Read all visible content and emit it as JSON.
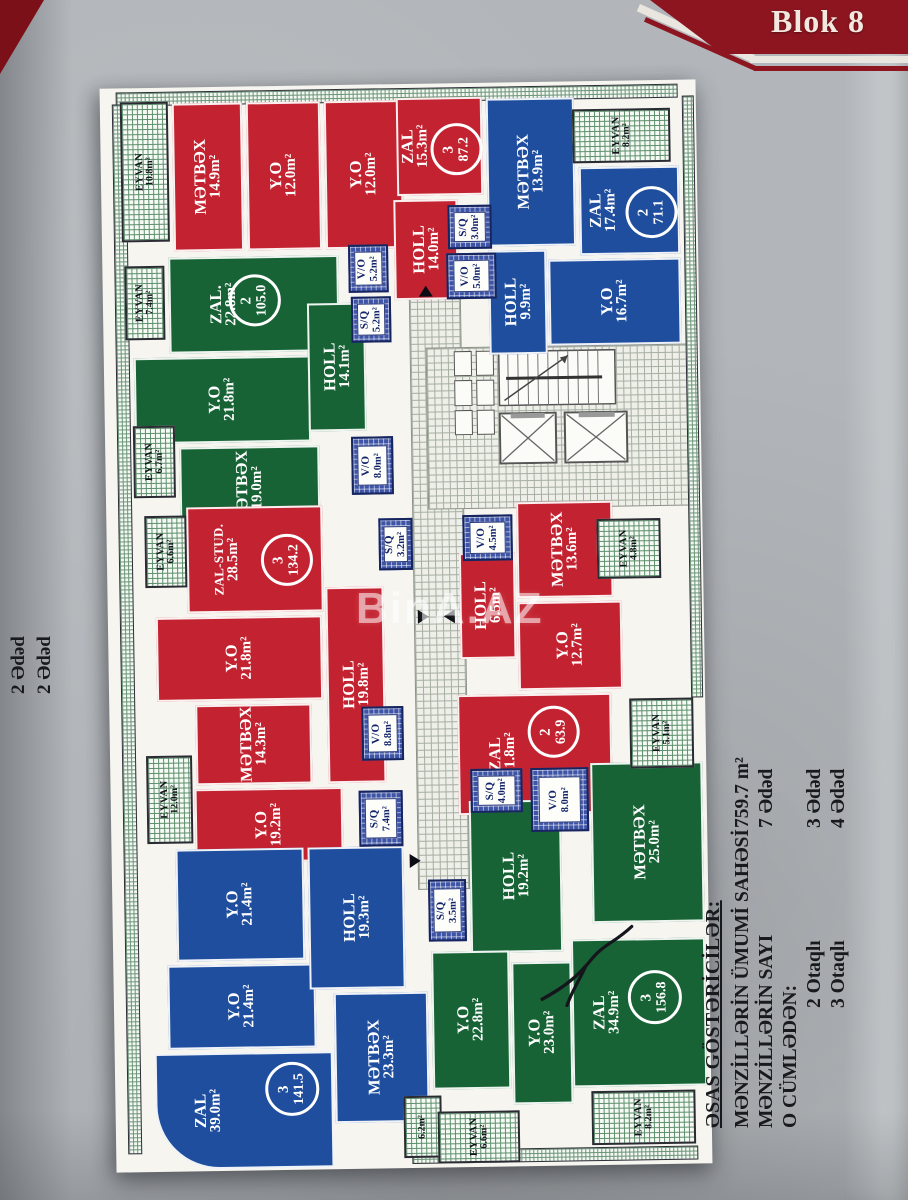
{
  "banner": {
    "title": "Blok 8"
  },
  "watermark_text": "BinA.AZ",
  "side_note": {
    "lines": [
      "2 Ədəd",
      "2 Ədəd"
    ]
  },
  "legend": {
    "title": "ƏSAS GÖSTƏRİCİLƏR:",
    "rows": [
      {
        "label": "MƏNZİLLƏRİN ÜMUMİ SAHƏSİ",
        "value": "759.7 m²",
        "indent": false
      },
      {
        "label": "MƏNZİLLƏRİN SAYI",
        "value": "7 Ədəd",
        "indent": false
      },
      {
        "label": "O CÜMLƏDƏN:",
        "value": "",
        "indent": false
      },
      {
        "label": "2 Otaqlı",
        "value": "3 Ədəd",
        "indent": true
      },
      {
        "label": "3 Otaqlı",
        "value": "4 Ədəd",
        "indent": true
      }
    ]
  },
  "colors": {
    "red": "#c32330",
    "blue": "#1e4e9d",
    "green": "#176335",
    "banner": "#8d1520",
    "corner": "#7c1019",
    "wet_hatch": "#3e54a6",
    "tile_floor": "#edefe8"
  },
  "plan": {
    "rooms": [
      {
        "type": "room",
        "color": "r",
        "name": "MƏTBƏX",
        "area": "14.9m²",
        "x": 72,
        "y": 16,
        "w": 70,
        "h": 148
      },
      {
        "type": "room",
        "color": "r",
        "name": "Y.O",
        "area": "12.0m²",
        "x": 146,
        "y": 16,
        "w": 74,
        "h": 148
      },
      {
        "type": "room",
        "color": "r",
        "name": "Y.O",
        "area": "12.0m²",
        "x": 224,
        "y": 16,
        "w": 78,
        "h": 148
      },
      {
        "type": "room",
        "color": "r",
        "name": "ZAL",
        "area": "15.3m²",
        "x": 296,
        "y": 14,
        "w": 86,
        "h": 98,
        "dx": -24
      },
      {
        "type": "room",
        "color": "r",
        "name": "HOLL",
        "area": "14.0m²",
        "x": 292,
        "y": 116,
        "w": 64,
        "h": 100
      },
      {
        "type": "balc",
        "name": "EYVAN",
        "area": "10.8m²",
        "x": 20,
        "y": 14,
        "w": 48,
        "h": 140
      },
      {
        "type": "wet",
        "name": "S/Q",
        "area": "3.0m²",
        "x": 346,
        "y": 122,
        "w": 44,
        "h": 44
      },
      {
        "type": "wet",
        "name": "V/O",
        "area": "5.0m²",
        "x": 344,
        "y": 170,
        "w": 50,
        "h": 46
      },
      {
        "type": "room",
        "color": "b",
        "name": "MƏTBƏX",
        "area": "13.9m²",
        "x": 386,
        "y": 16,
        "w": 88,
        "h": 148
      },
      {
        "type": "room",
        "color": "b",
        "name": "ZAL",
        "area": "17.4m²",
        "x": 478,
        "y": 86,
        "w": 100,
        "h": 88,
        "dx": -26
      },
      {
        "type": "room",
        "color": "b",
        "name": "Y.O",
        "area": "16.7m²",
        "x": 446,
        "y": 178,
        "w": 132,
        "h": 86
      },
      {
        "type": "room",
        "color": "b",
        "name": "HOLL",
        "area": "9.9m²",
        "x": 386,
        "y": 168,
        "w": 58,
        "h": 104
      },
      {
        "type": "balc",
        "name": "EYVAN",
        "area": "8.2m²",
        "x": 472,
        "y": 28,
        "w": 98,
        "h": 54
      },
      {
        "type": "room",
        "color": "g",
        "name": "ZAL.",
        "area": "22.8m²",
        "x": 66,
        "y": 170,
        "w": 170,
        "h": 96,
        "dx": -30
      },
      {
        "type": "room",
        "color": "g",
        "name": "Y.O",
        "area": "21.8m²",
        "x": 30,
        "y": 270,
        "w": 176,
        "h": 86
      },
      {
        "type": "room",
        "color": "g",
        "name": "MƏTBƏX",
        "area": "19.0m²",
        "x": 74,
        "y": 360,
        "w": 140,
        "h": 84
      },
      {
        "type": "room",
        "color": "g",
        "name": "HOLL",
        "area": "14.1m²",
        "x": 204,
        "y": 218,
        "w": 58,
        "h": 128
      },
      {
        "type": "wet",
        "name": "V/O",
        "area": "5.2m²",
        "x": 246,
        "y": 160,
        "w": 40,
        "h": 48
      },
      {
        "type": "wet",
        "name": "S/Q",
        "area": "5.2m²",
        "x": 248,
        "y": 212,
        "w": 40,
        "h": 46
      },
      {
        "type": "wet",
        "name": "V/O",
        "area": "8.0m²",
        "x": 246,
        "y": 352,
        "w": 42,
        "h": 58
      },
      {
        "type": "balc",
        "name": "EYVAN",
        "area": "7.4m²",
        "x": 22,
        "y": 178,
        "w": 40,
        "h": 74
      },
      {
        "type": "balc",
        "name": "EYVAN",
        "area": "6.7m²",
        "x": 28,
        "y": 338,
        "w": 42,
        "h": 72
      },
      {
        "type": "room",
        "color": "r",
        "name": "ZAL-STUD.",
        "area": "28.5m²",
        "x": 80,
        "y": 420,
        "w": 136,
        "h": 106,
        "dx": -28
      },
      {
        "type": "room",
        "color": "r",
        "name": "Y.O",
        "area": "21.8m²",
        "x": 48,
        "y": 530,
        "w": 166,
        "h": 84
      },
      {
        "type": "room",
        "color": "r",
        "name": "MƏTBƏX",
        "area": "14.3m²",
        "x": 86,
        "y": 618,
        "w": 116,
        "h": 80
      },
      {
        "type": "room",
        "color": "r",
        "name": "Y.O",
        "area": "19.2m²",
        "x": 84,
        "y": 702,
        "w": 148,
        "h": 74
      },
      {
        "type": "room",
        "color": "r",
        "name": "HOLL",
        "area": "19.8m²",
        "x": 218,
        "y": 502,
        "w": 58,
        "h": 196
      },
      {
        "type": "wet",
        "name": "S/Q",
        "area": "3.2m²",
        "x": 272,
        "y": 434,
        "w": 34,
        "h": 52
      },
      {
        "type": "wet",
        "name": "V/O",
        "area": "8.8m²",
        "x": 252,
        "y": 622,
        "w": 42,
        "h": 54
      },
      {
        "type": "wet",
        "name": "S/Q",
        "area": "7.4m²",
        "x": 248,
        "y": 706,
        "w": 44,
        "h": 56
      },
      {
        "type": "balc",
        "name": "EYVAN",
        "area": "6.6m²",
        "x": 38,
        "y": 428,
        "w": 42,
        "h": 72
      },
      {
        "type": "balc",
        "name": "EYVAN",
        "area": "12.0m²",
        "x": 36,
        "y": 668,
        "w": 46,
        "h": 88
      },
      {
        "type": "room",
        "color": "r",
        "name": "MƏTBƏX",
        "area": "13.6m²",
        "x": 410,
        "y": 420,
        "w": 96,
        "h": 96
      },
      {
        "type": "room",
        "color": "r",
        "name": "HOLL",
        "area": "6.5m²",
        "x": 352,
        "y": 470,
        "w": 56,
        "h": 106
      },
      {
        "type": "room",
        "color": "r",
        "name": "Y.O",
        "area": "12.7m²",
        "x": 410,
        "y": 520,
        "w": 104,
        "h": 88
      },
      {
        "type": "room",
        "color": "r",
        "name": "ZAL",
        "area": "21.8m²",
        "x": 348,
        "y": 612,
        "w": 154,
        "h": 120,
        "dx": -32
      },
      {
        "type": "wet",
        "name": "V/O",
        "area": "4.5m²",
        "x": 356,
        "y": 432,
        "w": 50,
        "h": 46
      },
      {
        "type": "balc",
        "name": "EYVAN",
        "area": "4.8m²",
        "x": 490,
        "y": 438,
        "w": 64,
        "h": 60
      },
      {
        "type": "balc",
        "name": "EYVAN",
        "area": "5.1m²",
        "x": 520,
        "y": 618,
        "w": 64,
        "h": 70
      },
      {
        "type": "room",
        "color": "b",
        "name": "Y.O",
        "area": "21.4m²",
        "x": 64,
        "y": 762,
        "w": 128,
        "h": 112
      },
      {
        "type": "room",
        "color": "b",
        "name": "Y.O",
        "area": "21.4m²",
        "x": 54,
        "y": 878,
        "w": 148,
        "h": 84
      },
      {
        "type": "room",
        "color": "b",
        "name": "HOLL",
        "area": "19.3m²",
        "x": 196,
        "y": 762,
        "w": 96,
        "h": 142
      },
      {
        "type": "room",
        "color": "b",
        "name": "MƏTBƏX",
        "area": "23.3m²",
        "x": 220,
        "y": 908,
        "w": 94,
        "h": 130
      },
      {
        "type": "room",
        "color": "b",
        "name": "ZAL",
        "area": "39.0m²",
        "x": 40,
        "y": 966,
        "w": 178,
        "h": 116,
        "dx": -36,
        "round": true
      },
      {
        "type": "balc",
        "name": "",
        "area": "6.2m²",
        "x": 288,
        "y": 1012,
        "w": 38,
        "h": 62
      },
      {
        "type": "room",
        "color": "g",
        "name": "MƏTBƏX",
        "area": "25.0m²",
        "x": 480,
        "y": 682,
        "w": 112,
        "h": 160
      },
      {
        "type": "room",
        "color": "g",
        "name": "HOLL",
        "area": "19.2m²",
        "x": 358,
        "y": 718,
        "w": 92,
        "h": 152
      },
      {
        "type": "wet",
        "name": "S/Q",
        "area": "4.0m²",
        "x": 360,
        "y": 686,
        "w": 52,
        "h": 44
      },
      {
        "type": "wet",
        "name": "V/O",
        "area": "8.0m²",
        "x": 420,
        "y": 686,
        "w": 58,
        "h": 64
      },
      {
        "type": "room",
        "color": "g",
        "name": "ZAL",
        "area": "34.9m²",
        "x": 458,
        "y": 858,
        "w": 134,
        "h": 148,
        "dx": -32
      },
      {
        "type": "room",
        "color": "g",
        "name": "Y.O",
        "area": "23.0m²",
        "x": 398,
        "y": 880,
        "w": 60,
        "h": 142
      },
      {
        "type": "room",
        "color": "g",
        "name": "Y.O",
        "area": "22.8m²",
        "x": 318,
        "y": 868,
        "w": 78,
        "h": 138
      },
      {
        "type": "wet",
        "name": "S/Q",
        "area": "3.5m²",
        "x": 316,
        "y": 796,
        "w": 38,
        "h": 62
      },
      {
        "type": "balc",
        "name": "EYVAN",
        "area": "6.6m²",
        "x": 322,
        "y": 1028,
        "w": 82,
        "h": 52
      },
      {
        "type": "balc",
        "name": "EYVAN",
        "area": "8.2m²",
        "x": 476,
        "y": 1010,
        "w": 104,
        "h": 54
      }
    ],
    "badges": [
      {
        "x": 330,
        "y": 40,
        "d": 46,
        "rooms": "3",
        "total": "87.2"
      },
      {
        "x": 524,
        "y": 106,
        "d": 46,
        "rooms": "2",
        "total": "71.1"
      },
      {
        "x": 126,
        "y": 188,
        "d": 46,
        "rooms": "2",
        "total": "105.0"
      },
      {
        "x": 154,
        "y": 448,
        "d": 46,
        "rooms": "3",
        "total": "134.2"
      },
      {
        "x": 418,
        "y": 624,
        "d": 46,
        "rooms": "2",
        "total": "63.9"
      },
      {
        "x": 150,
        "y": 976,
        "d": 48,
        "rooms": "3",
        "total": "141.5"
      },
      {
        "x": 514,
        "y": 890,
        "d": 48,
        "rooms": "3",
        "total": "156.8"
      }
    ],
    "corridors": [
      {
        "x": 306,
        "y": 210,
        "w": 50,
        "h": 594
      },
      {
        "x": 322,
        "y": 264,
        "w": 268,
        "h": 160
      }
    ],
    "arrows": [
      {
        "dir": "up",
        "x": 316,
        "y": 202
      },
      {
        "dir": "right",
        "x": 310,
        "y": 526
      },
      {
        "dir": "left",
        "x": 336,
        "y": 526
      },
      {
        "dir": "right",
        "x": 298,
        "y": 770
      }
    ]
  }
}
